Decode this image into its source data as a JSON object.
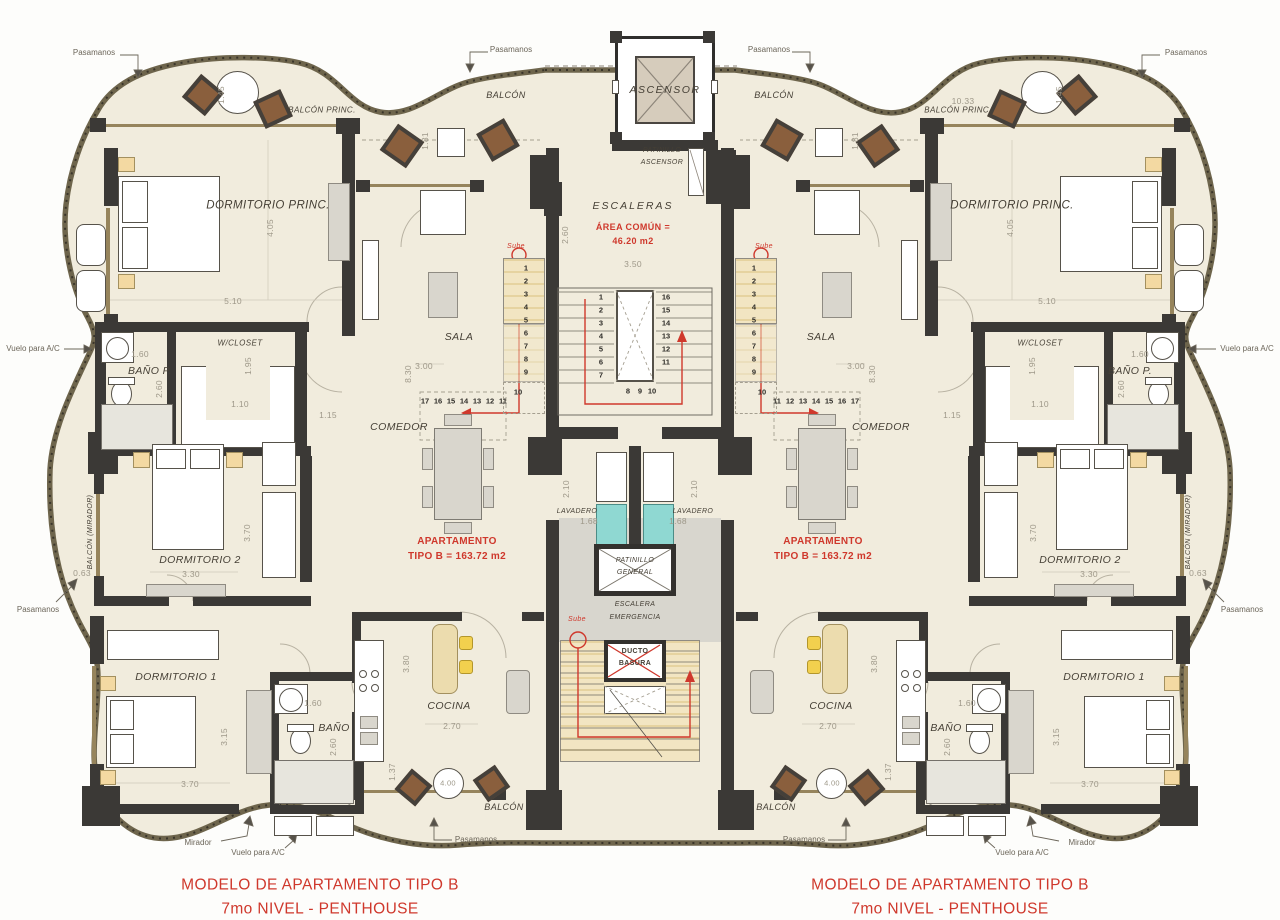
{
  "plan": {
    "title_left_1": "MODELO DE APARTAMENTO TIPO B",
    "title_left_2": "7mo NIVEL - PENTHOUSE",
    "title_right_1": "MODELO DE APARTAMENTO TIPO B",
    "title_right_2": "7mo NIVEL - PENTHOUSE"
  },
  "core": {
    "ascensor": "ASCENSOR",
    "patinillo_ascensor_1": "PATINILLO",
    "patinillo_ascensor_2": "ASCENSOR",
    "escaleras": "ESCALERAS",
    "area_comun_1": "ÁREA COMÚN =",
    "area_comun_2": "46.20 m2",
    "d |im_width": "3.50",
    "dim_width": "3.50",
    "dim_height": "2.60",
    "stair_left": [
      "1",
      "2",
      "3",
      "4",
      "5",
      "6",
      "7"
    ],
    "stair_right": [
      "16",
      "15",
      "14",
      "13",
      "12",
      "11"
    ],
    "stair_bottom": [
      "8",
      "9",
      "10"
    ],
    "lavadero": "LAVADERO",
    "dim_lavadero_h": "2.10",
    "dim_lavadero_w": "1.68",
    "patinillo_general_1": "PATINILLO",
    "patinillo_general_2": "GENERAL",
    "escalera_emergencia_1": "ESCALERA",
    "escalera_emergencia_2": "EMERGENCIA",
    "sube": "Sube",
    "ducto_1": "DUCTO",
    "ducto_2": "BASURA",
    "dim_balcon_right": "10.33"
  },
  "apartment": {
    "area_label_1": "APARTAMENTO",
    "area_label_2": "TIPO B = 163.72 m2",
    "rooms": {
      "dormitorio_princ": "DORMITORIO PRINC.",
      "balcon_princ": "BALCÓN PRINC.",
      "wcloset": "W/CLOSET",
      "bano_p": "BAÑO P.",
      "dormitorio_2": "DORMITORIO 2",
      "dormitorio_1": "DORMITORIO 1",
      "bano": "BAÑO",
      "cocina": "COCINA",
      "sala": "SALA",
      "comedor": "COMEDOR",
      "balcon_top": "BALCÓN",
      "balcon_bottom": "BALCÓN",
      "balcon_mirador": "BALCÓN (MIRADOR)"
    },
    "stairs": {
      "sube": "Sube",
      "col": [
        "1",
        "2",
        "3",
        "4",
        "5",
        "6",
        "7",
        "8",
        "9"
      ],
      "n10": "10",
      "row": [
        "11",
        "12",
        "13",
        "14",
        "15",
        "16",
        "17"
      ]
    },
    "dims": {
      "balcon_princ_w": "1.45",
      "balcon_sala_w": "1.81",
      "dorm_princ_h": "4.05",
      "dorm_princ_w": "5.10",
      "bano_p_w": "1.60",
      "bano_p_h": "2.60",
      "wcloset_h": "1.95",
      "wcloset_w": "1.10",
      "pasillo_w": "1.15",
      "dorm_2_h": "3.70",
      "dorm_2_w": "3.30",
      "balcon_mirador_w": "0.63",
      "dorm_1_h": "3.15",
      "dorm_1_w": "3.70",
      "bano_w": "1.60",
      "bano_h": "2.60",
      "balcon_d": "1.37",
      "cocina_w": "2.70",
      "cocina_h": "3.80",
      "balcon_table": "4.00",
      "sala_w": "3.00",
      "sala_h": "8.30"
    },
    "callouts": {
      "pasamanos": "Pasamanos",
      "mirador": "Mirador",
      "vuelo_ac": "Vuelo para A/C"
    }
  }
}
